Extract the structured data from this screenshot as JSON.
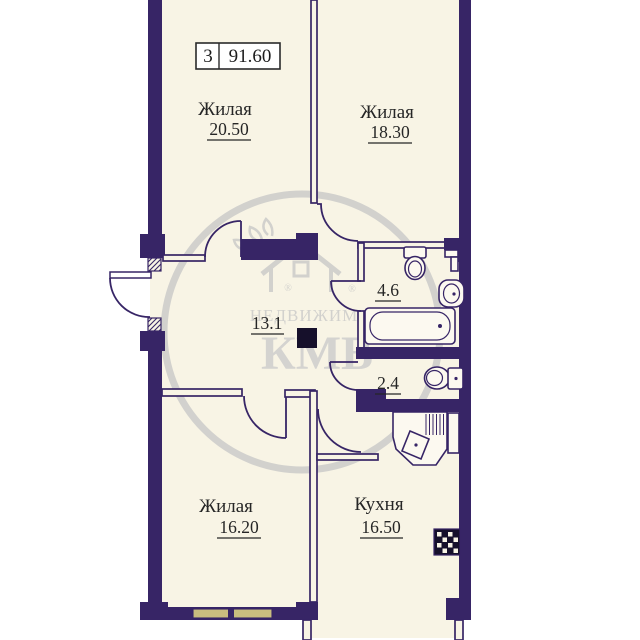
{
  "title_box": {
    "rooms_count": "3",
    "total_area": "91.60"
  },
  "rooms": [
    {
      "id": "living1",
      "name": "Жилая",
      "area": "20.50"
    },
    {
      "id": "living2",
      "name": "Жилая",
      "area": "18.30"
    },
    {
      "id": "hall",
      "name": "",
      "area": "13.1"
    },
    {
      "id": "bathroom",
      "name": "",
      "area": "4.6"
    },
    {
      "id": "wc",
      "name": "",
      "area": "2.4"
    },
    {
      "id": "living3",
      "name": "Жилая",
      "area": "16.20"
    },
    {
      "id": "kitchen",
      "name": "Кухня",
      "area": "16.50"
    }
  ],
  "fixtures": [
    "toilet",
    "wash-basin",
    "bathtub",
    "wc-toilet",
    "kitchen-counter-sink",
    "stove",
    "window",
    "vent-shaft"
  ],
  "watermark": {
    "line1": "НЕДВИЖИМОСТЬ",
    "line2": "КМВ",
    "reg_mark": "®"
  },
  "colors": {
    "wall": "#372566",
    "floor": "#f8f4e5",
    "outside": "#ffffff",
    "window_band": "#c9bd7f",
    "watermark_gray": "#c6c6c6",
    "text": "#262626",
    "shaft_black": "#16102b"
  }
}
